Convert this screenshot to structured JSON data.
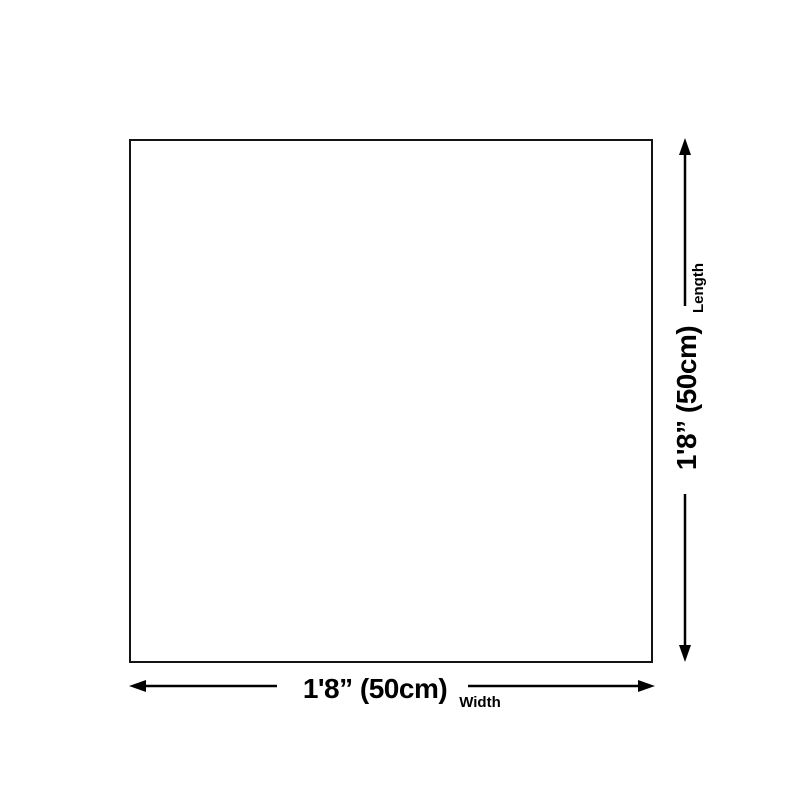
{
  "diagram": {
    "background_color": "#ffffff",
    "line_color": "#000000",
    "square_border_color": "#141414",
    "length_dimension": {
      "value": "1'8” (50cm)",
      "label": "Length"
    },
    "width_dimension": {
      "value": "1'8” (50cm)",
      "label": "Width"
    }
  }
}
